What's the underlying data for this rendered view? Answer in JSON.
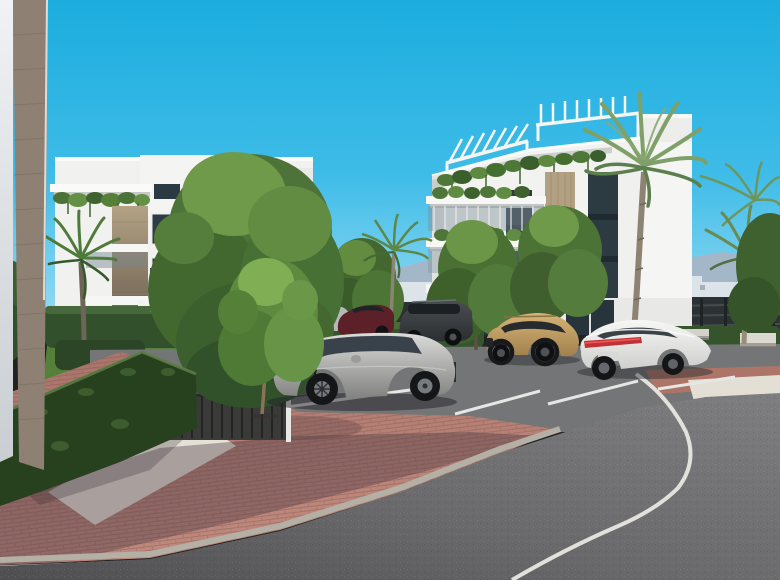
{
  "scene": {
    "type": "architectural-render",
    "setting": "Modern white apartment complex with landscaped brick plaza, parked cars, palm trees and a curved asphalt road under a clear cyan sky",
    "objects": [
      "left-apartment-building",
      "right-apartment-building",
      "foreground-corner-wall",
      "box-hedges",
      "deciduous-trees",
      "palm-trees",
      "parasol",
      "sun-loungers",
      "gate-structure",
      "parking-bays",
      "brick-plaza",
      "gravel-bed",
      "curved-road",
      "curb",
      "road-edge-line",
      "distant-mountains",
      "distant-buildings",
      "perimeter-fence",
      "lawn",
      "bollards",
      "benches",
      "construction-crane"
    ],
    "vehicles": [
      {
        "name": "black-sedan",
        "color": "#1d1f21"
      },
      {
        "name": "silver-suv",
        "color": "#b9bab8"
      },
      {
        "name": "light-gray-car",
        "color": "#b6b9bb"
      },
      {
        "name": "dark-red-sedan",
        "color": "#5c2128"
      },
      {
        "name": "dark-gray-suv",
        "color": "#3f4347"
      },
      {
        "name": "gold-suv",
        "color": "#c5a068"
      },
      {
        "name": "white-sedan",
        "color": "#ededeb"
      }
    ]
  },
  "palette": {
    "sky_top": "#1badde",
    "sky_bottom": "#96dbf2",
    "mountain": "#a7b5c6",
    "distant_building": "#dde4e9",
    "white_facade": "#f2f2f0",
    "facade_shade": "#e0e1df",
    "tan_panel": "#b2a083",
    "tan_wall": "#8e8173",
    "hedge_dark": "#27411f",
    "hedge_band": "#35542c",
    "hedge_light": "#4f7a35",
    "lawn": "#5d8a3f",
    "tree_green": "#4e7338",
    "palm_green": "#6f9a5c",
    "brick": "#b5796d",
    "brick_shadow": "#6e5158",
    "gravel": "#e4dfd5",
    "asphalt": "#737476",
    "road_dark": "#58585a",
    "curb": "#b4b0a6",
    "line_white": "#e9e7e2",
    "fence": "#2c3133",
    "taillight": "#c23038"
  }
}
